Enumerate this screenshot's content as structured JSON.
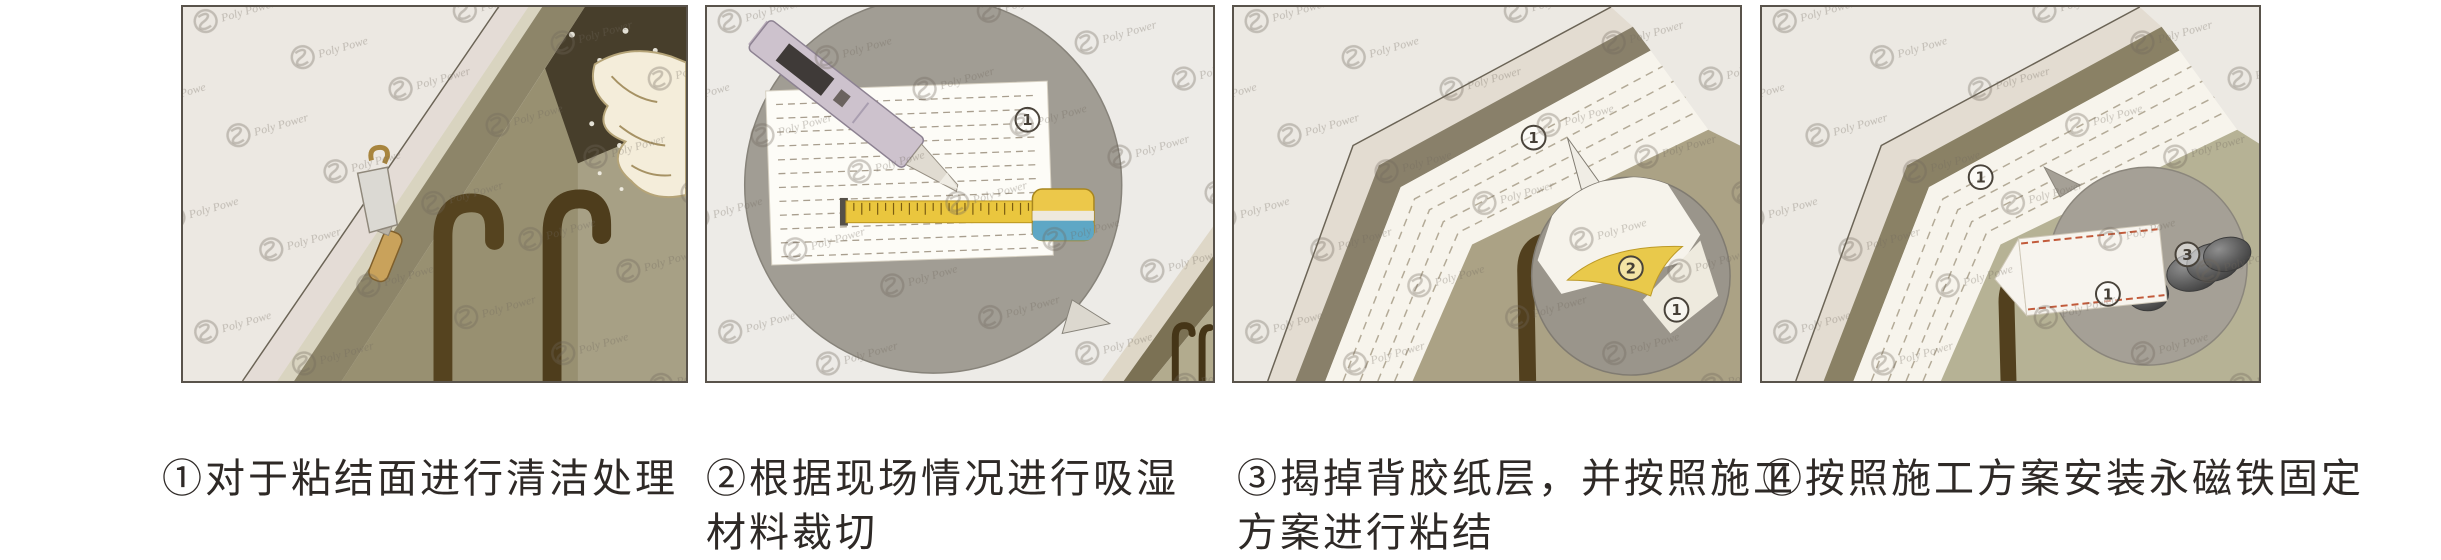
{
  "figure": {
    "watermark_text": "Poly Power",
    "steps": [
      {
        "caption_lines": [
          "①对于粘结面进行清洁处理"
        ],
        "markers": {}
      },
      {
        "caption_lines": [
          "②根据现场情况进行吸湿",
          "材料裁切"
        ],
        "markers": {
          "sheet": "1"
        }
      },
      {
        "caption_lines": [
          "③揭掉背胶纸层，并按照施工",
          "方案进行粘结"
        ],
        "markers": {
          "strip": "1",
          "peel": "2",
          "sheet": "1"
        }
      },
      {
        "caption_lines": [
          "④按照施工方案安装永磁铁固定"
        ],
        "markers": {
          "strip": "1",
          "sheet": "1",
          "magnet": "3"
        }
      }
    ],
    "colors": {
      "caption_text": "#2e2926",
      "panel_border": "#59534b",
      "tape_yellow": "#eac63e",
      "tape_case_blue": "#5ea7c5",
      "peel_yellow": "#e9c94b",
      "magnet_gray": "#555555",
      "red_dash": "#c25a3a"
    }
  }
}
